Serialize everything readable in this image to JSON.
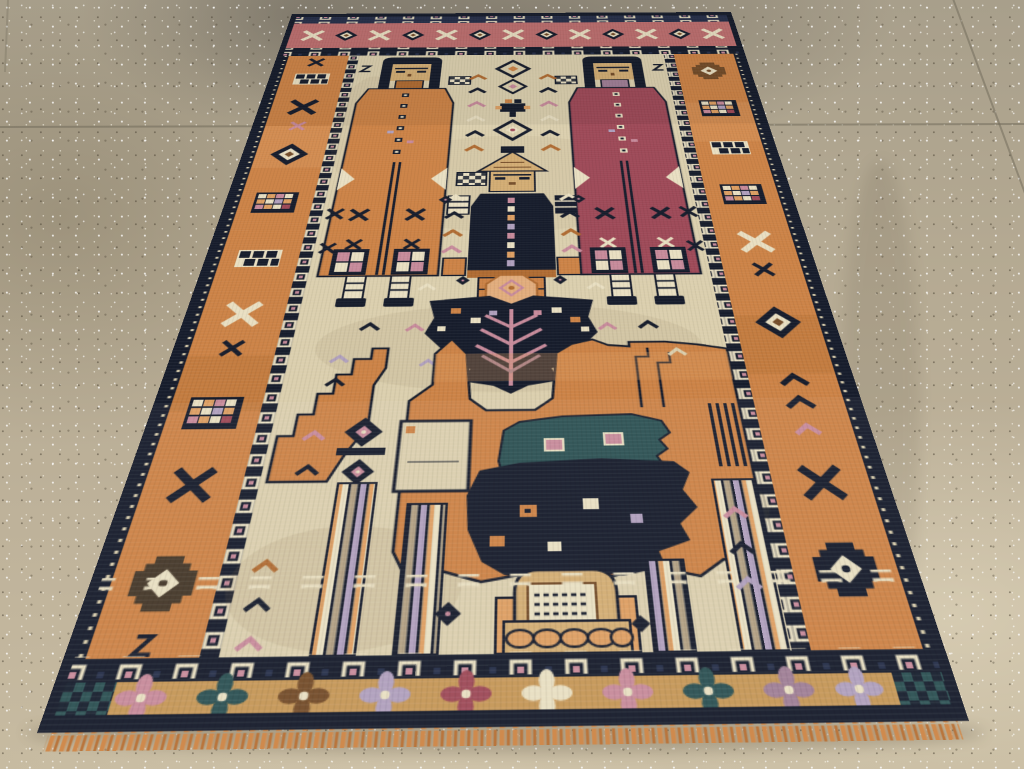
{
  "scene": {
    "type": "photograph",
    "description": "Antique tribal pictorial rug lying on a speckled terrazzo tile floor, photographed in perspective from one end",
    "rug_subjects": [
      "tall robed figure in orange on the left",
      "tall robed figure in maroon on the right",
      "small central figure with peaked roof-like hat and dark coat",
      "dark moth-shaped medallion with peach crown",
      "large stylized orange animal",
      "teal calf with pink spots",
      "dark navy foal with box spots",
      "striped tree-trunk columns",
      "arched monument with woven inscription marks",
      "rose end border with cross motifs",
      "orange side borders with checkered and star medallions",
      "tan flower-rosette bottom border",
      "navy box-chain guard bands",
      "orange fringe"
    ],
    "floor": "polished speckled terrazzo tiles with thin grout lines and light stains"
  },
  "palette": {
    "navy": "#27304a",
    "navyDeep": "#171d2c",
    "teal": "#2d5254",
    "rose": "#bd6f6f",
    "maroon": "#9e4a58",
    "orange": "#cc8347",
    "orangeDeep": "#b06c33",
    "orangeLight": "#dd9f63",
    "cream": "#dbcfae",
    "creamLight": "#e9dfc2",
    "tanFace": "#d3ad74",
    "tanBand": "#c59758",
    "brown": "#744d2a",
    "brownDark": "#46392a",
    "drab": "#b3a184",
    "lilac": "#b0a0bd",
    "mauve": "#a07f96",
    "rosePink": "#c78b9b",
    "peach": "#e2ad7d",
    "fringe": "#cf8a4d",
    "fringeDark": "#b9753c",
    "floor": "#b3a88f",
    "groutLine": "#6e6858"
  }
}
